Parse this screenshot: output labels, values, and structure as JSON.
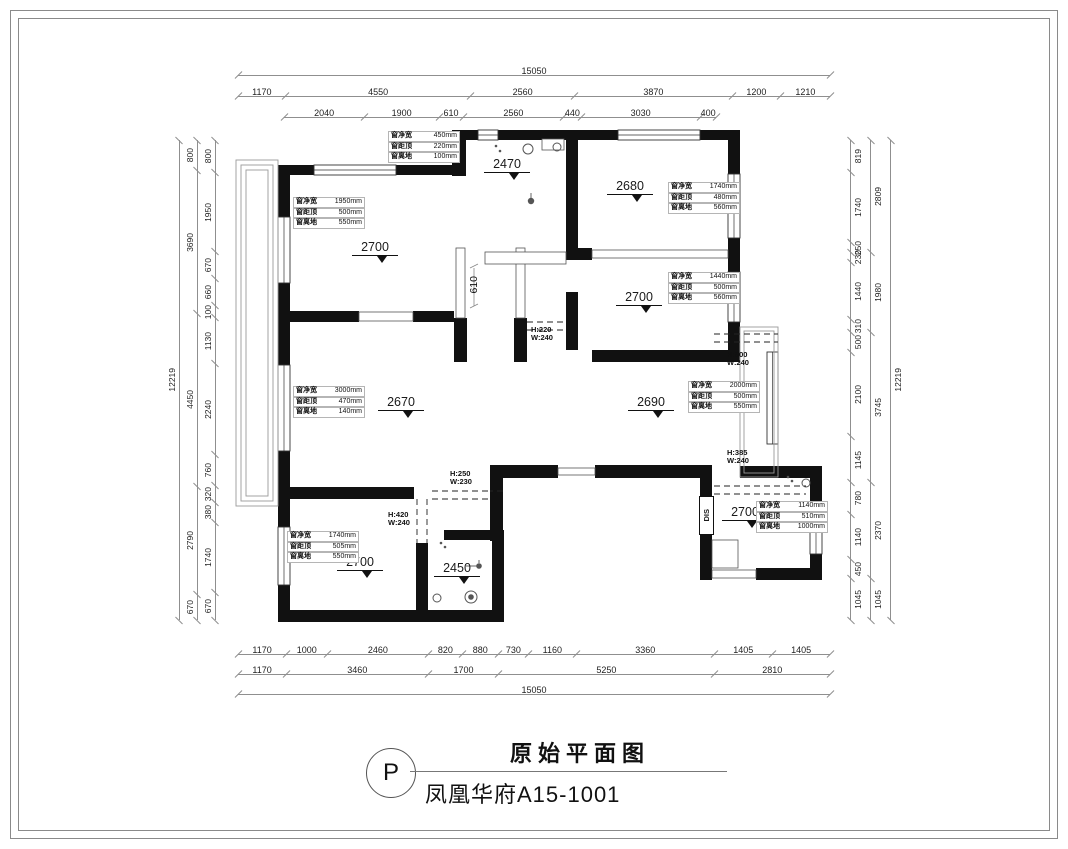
{
  "sheet": {
    "stamp": "P",
    "title": "原始平面图",
    "subtitle": "凤凰华府A15-1001"
  },
  "dims": {
    "top": {
      "total": "15050",
      "row2": [
        "1170",
        "4550",
        "2560",
        "3870",
        "1200",
        "1210"
      ],
      "row3": [
        "2040",
        "1900",
        "610",
        "2560",
        "440",
        "3030",
        "400"
      ]
    },
    "bottom": {
      "row1": [
        "1170",
        "1000",
        "2460",
        "820",
        "880",
        "730",
        "1160",
        "3360",
        "1405",
        "1405"
      ],
      "row2": [
        "1170",
        "3460",
        "1700",
        "5250",
        "2810"
      ],
      "total": "15050"
    },
    "left": {
      "total": "12219",
      "mid": [
        "800",
        "3690",
        "4450",
        "2790",
        "670"
      ],
      "inner": [
        "800",
        "1950",
        "670",
        "660",
        "100",
        "1130",
        "2240",
        "760",
        "320",
        "380",
        "1740",
        "670"
      ]
    },
    "right": {
      "total": "12219",
      "mid": [
        "2809",
        "1980",
        "3745",
        "2370",
        "1045"
      ],
      "inner": [
        "819",
        "1740",
        "250",
        "230",
        "1440",
        "310",
        "500",
        "2100",
        "1145",
        "780",
        "1140",
        "450",
        "1045"
      ]
    }
  },
  "levels": [
    "2470",
    "2680",
    "2700",
    "2700",
    "2670",
    "2690",
    "2700",
    "2450",
    "2700"
  ],
  "windows": [
    {
      "rows": [
        {
          "label": "窗净宽",
          "value": "450mm"
        },
        {
          "label": "窗距顶",
          "value": "220mm"
        },
        {
          "label": "窗离地",
          "value": "100mm"
        }
      ]
    },
    {
      "rows": [
        {
          "label": "窗净宽",
          "value": "1950mm"
        },
        {
          "label": "窗距顶",
          "value": "500mm"
        },
        {
          "label": "窗离地",
          "value": "550mm"
        }
      ]
    },
    {
      "rows": [
        {
          "label": "窗净宽",
          "value": "1740mm"
        },
        {
          "label": "窗距顶",
          "value": "480mm"
        },
        {
          "label": "窗离地",
          "value": "560mm"
        }
      ]
    },
    {
      "rows": [
        {
          "label": "窗净宽",
          "value": "1440mm"
        },
        {
          "label": "窗距顶",
          "value": "500mm"
        },
        {
          "label": "窗离地",
          "value": "560mm"
        }
      ]
    },
    {
      "rows": [
        {
          "label": "窗净宽",
          "value": "3000mm"
        },
        {
          "label": "窗距顶",
          "value": "470mm"
        },
        {
          "label": "窗离地",
          "value": "140mm"
        }
      ]
    },
    {
      "rows": [
        {
          "label": "窗净宽",
          "value": "2000mm"
        },
        {
          "label": "窗距顶",
          "value": "500mm"
        },
        {
          "label": "窗离地",
          "value": "550mm"
        }
      ]
    },
    {
      "rows": [
        {
          "label": "窗净宽",
          "value": "1740mm"
        },
        {
          "label": "窗距顶",
          "value": "505mm"
        },
        {
          "label": "窗离地",
          "value": "550mm"
        }
      ]
    },
    {
      "rows": [
        {
          "label": "窗净宽",
          "value": "1140mm"
        },
        {
          "label": "窗距顶",
          "value": "510mm"
        },
        {
          "label": "窗离地",
          "value": "1000mm"
        }
      ]
    }
  ],
  "beams": [
    {
      "h": "H:220",
      "w": "W:240"
    },
    {
      "h": "H:500",
      "w": "W:240"
    },
    {
      "h": "H:250",
      "w": "W:230"
    },
    {
      "h": "H:420",
      "w": "W:240"
    },
    {
      "h": "H:385",
      "w": "W:240"
    }
  ],
  "labels": {
    "hall_height": "610",
    "shaft": "DIS"
  }
}
